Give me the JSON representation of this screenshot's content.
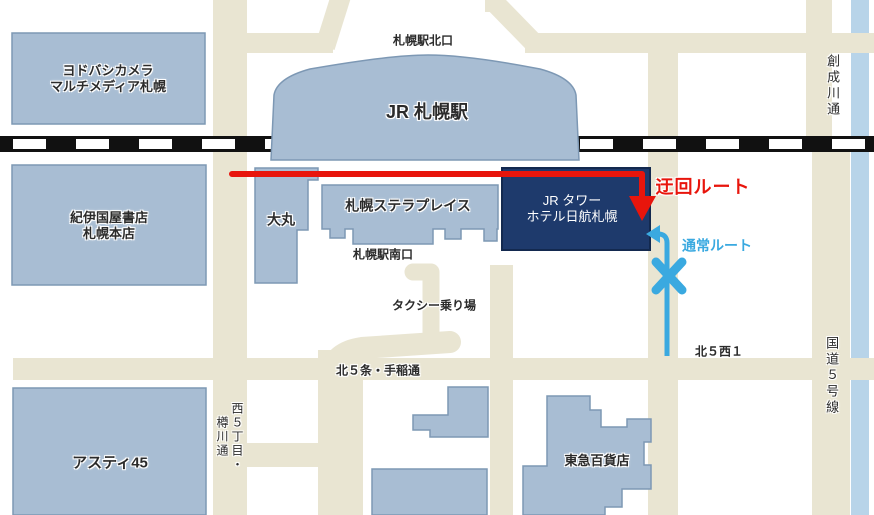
{
  "map": {
    "buildings": {
      "yodobashi": {
        "label": "ヨドバシカメラ\nマルチメディア札幌"
      },
      "kinokuniya": {
        "label": "紀伊国屋書店\n札幌本店"
      },
      "jr_sapporo_station": {
        "label": "JR 札幌駅"
      },
      "daimaru": {
        "label": "大丸"
      },
      "sapporo_stellar_place": {
        "label": "札幌ステラプレイス"
      },
      "jr_tower_hotel_nikko": {
        "label": "JR タワー\nホテル日航札幌"
      },
      "asty45": {
        "label": "アスティ45"
      },
      "tokyu_dept_store": {
        "label": "東急百貨店"
      }
    },
    "labels": {
      "station_north_exit": "札幌駅北口",
      "station_south_exit": "札幌駅南口",
      "taxi_stand": "タクシー乗り場",
      "kita5_nishi1": "北５西１"
    },
    "roads": {
      "soseigawa_dori": "創成川通",
      "kokudo5_gosen": "国道５号線",
      "kita5jo_teine_dori": "北５条・手稲通",
      "nishi5chome_tarukawa_dori": "西５丁目・樽川通"
    },
    "routes": {
      "detour": {
        "label": "迂回ルート",
        "color": "#e8150c"
      },
      "normal": {
        "label": "通常ルート",
        "color": "#3aa9e0"
      }
    },
    "colors": {
      "background": "#ffffff",
      "building_fill": "#a8bdd3",
      "building_border": "#7d98b4",
      "hotel_fill": "#1e3a6c",
      "road": "#e9e5d2",
      "river": "#b8d4e9",
      "railway": "#111111",
      "label_text": "#2b2b2b"
    }
  }
}
